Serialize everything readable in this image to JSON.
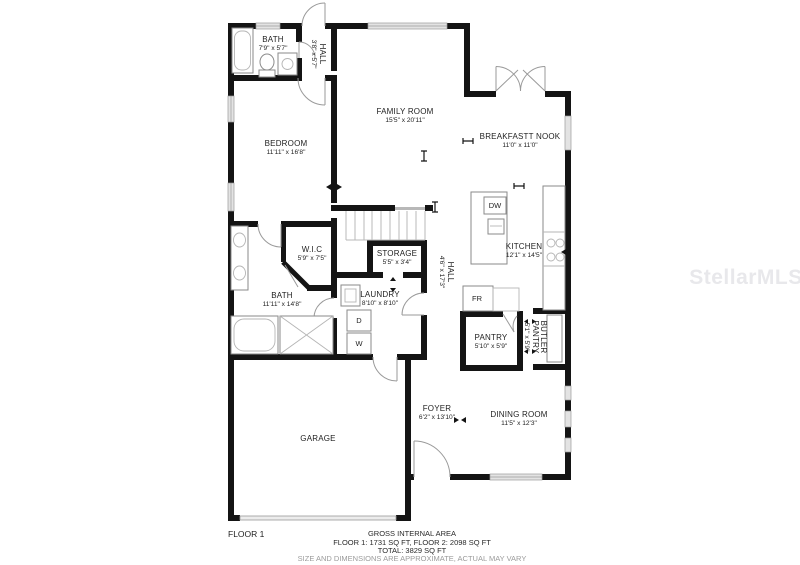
{
  "watermark": "StellarMLS",
  "floor_label": "FLOOR 1",
  "footer": {
    "title": "GROSS INTERNAL AREA",
    "floors": "FLOOR 1: 1731 SQ FT, FLOOR 2: 2098 SQ FT",
    "total": "TOTAL: 3829 SQ FT",
    "disclaimer": "SIZE AND DIMENSIONS ARE APPROXIMATE, ACTUAL MAY VARY"
  },
  "rooms": {
    "bath_upper": {
      "name": "BATH",
      "dims": "7'9\" x 5'7\""
    },
    "hall_upper": {
      "name": "HALL",
      "dims": "3'8\" x 5'7\""
    },
    "bedroom": {
      "name": "BEDROOM",
      "dims": "11'11\" x 16'8\""
    },
    "family_room": {
      "name": "FAMILY ROOM",
      "dims": "15'5\" x 20'11\""
    },
    "breakfast_nook": {
      "name": "BREAKFASTT NOOK",
      "dims": "11'0\" x 11'0\""
    },
    "kitchen": {
      "name": "KITCHEN",
      "dims": "12'1\" x 14'5\""
    },
    "wic": {
      "name": "W.I.C",
      "dims": "5'9\" x 7'5\""
    },
    "storage": {
      "name": "STORAGE",
      "dims": "5'5\" x 3'4\""
    },
    "bath_lower": {
      "name": "BATH",
      "dims": "11'11\" x 14'8\""
    },
    "laundry": {
      "name": "LAUNDRY",
      "dims": "8'10\" x 8'10\""
    },
    "hall_lower": {
      "name": "HALL",
      "dims": "4'6\" x 17'3\""
    },
    "pantry": {
      "name": "PANTRY",
      "dims": "5'10\" x 5'9\""
    },
    "butler_pantry": {
      "name_lines": [
        "BUTLER",
        "PANTRY"
      ],
      "dims": "5'1\" x 5'9\""
    },
    "foyer": {
      "name": "FOYER",
      "dims": "6'2\" x 13'10\""
    },
    "dining_room": {
      "name": "DINING ROOM",
      "dims": "11'5\" x 12'3\""
    },
    "garage": {
      "name": "GARAGE"
    }
  },
  "appliances": {
    "dishwasher": "DW",
    "fridge": "FR",
    "dryer": "D",
    "washer": "W"
  },
  "colors": {
    "wall": "#141414",
    "fixture_outline": "#8a8a8a",
    "window_fill": "#e3e3e3",
    "watermark": "#e8e8eb",
    "text": "#1f1f1f"
  }
}
